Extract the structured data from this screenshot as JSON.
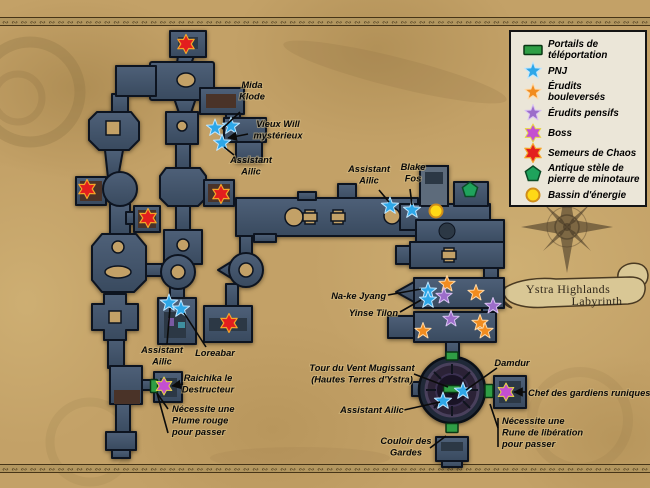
{
  "map_title": {
    "line1": "Ystra Highlands",
    "line2": "Labyrinth"
  },
  "colors": {
    "parchment": "#c3a167",
    "dungeon": "#44566c",
    "portail_vert": "#2f9e45",
    "pnj_bleu": "#2ea7e8",
    "erudit_orange": "#f18c1f",
    "pensif_violet": "#9c6dca",
    "boss_magenta": "#c44fd0",
    "semeur_rouge": "#e31e1e",
    "stele_vert": "#1fa35c",
    "energie_jaune": "#ffd916"
  },
  "decor": {
    "border_glyph": "∾ "
  },
  "legend": {
    "items": [
      {
        "type": "portail",
        "icon": "teleport-portal-icon",
        "label": "Portails de\ntéléportation"
      },
      {
        "type": "pnj",
        "icon": "pnj-star-icon",
        "label": "PNJ"
      },
      {
        "type": "bouleverse",
        "icon": "erudit-bouleverse-star-icon",
        "label": "Érudits bouleversés"
      },
      {
        "type": "pensif",
        "icon": "erudit-pensif-star-icon",
        "label": "Érudits pensifs"
      },
      {
        "type": "boss",
        "icon": "boss-star-icon",
        "label": "Boss"
      },
      {
        "type": "semeur",
        "icon": "semeur-chaos-star-icon",
        "label": "Semeurs de Chaos"
      },
      {
        "type": "stele",
        "icon": "minotaur-stele-icon",
        "label": "Antique stèle de\npierre de minotaure"
      },
      {
        "type": "energie",
        "icon": "energy-pool-icon",
        "label": "Bassin d'énergie"
      }
    ]
  },
  "markers": [
    {
      "type": "portail",
      "x": 452,
      "y": 356,
      "w": 12,
      "h": 8
    },
    {
      "type": "portail",
      "x": 452,
      "y": 389,
      "w": 17,
      "h": 7
    },
    {
      "type": "portail",
      "x": 452,
      "y": 428,
      "w": 12,
      "h": 9
    },
    {
      "type": "portail",
      "x": 489,
      "y": 391,
      "w": 8,
      "h": 13
    },
    {
      "type": "portail",
      "x": 154,
      "y": 386,
      "w": 7,
      "h": 13
    },
    {
      "type": "pnj",
      "x": 215,
      "y": 128
    },
    {
      "type": "pnj",
      "x": 231,
      "y": 126
    },
    {
      "type": "pnj",
      "x": 222,
      "y": 143
    },
    {
      "type": "pnj",
      "x": 390,
      "y": 206
    },
    {
      "type": "pnj",
      "x": 412,
      "y": 210
    },
    {
      "type": "pnj",
      "x": 428,
      "y": 291
    },
    {
      "type": "pnj",
      "x": 428,
      "y": 300
    },
    {
      "type": "pnj",
      "x": 169,
      "y": 303
    },
    {
      "type": "pnj",
      "x": 181,
      "y": 309
    },
    {
      "type": "pnj",
      "x": 443,
      "y": 401
    },
    {
      "type": "pnj",
      "x": 463,
      "y": 391
    },
    {
      "type": "bouleverse",
      "x": 447,
      "y": 284
    },
    {
      "type": "bouleverse",
      "x": 476,
      "y": 293
    },
    {
      "type": "bouleverse",
      "x": 480,
      "y": 323
    },
    {
      "type": "bouleverse",
      "x": 485,
      "y": 331
    },
    {
      "type": "bouleverse",
      "x": 423,
      "y": 331
    },
    {
      "type": "pensif",
      "x": 444,
      "y": 296
    },
    {
      "type": "pensif",
      "x": 493,
      "y": 306
    },
    {
      "type": "pensif",
      "x": 451,
      "y": 319
    },
    {
      "type": "boss",
      "x": 164,
      "y": 386
    },
    {
      "type": "boss",
      "x": 506,
      "y": 392
    },
    {
      "type": "semeur",
      "x": 186,
      "y": 44
    },
    {
      "type": "semeur",
      "x": 87,
      "y": 189
    },
    {
      "type": "semeur",
      "x": 148,
      "y": 218
    },
    {
      "type": "semeur",
      "x": 221,
      "y": 194
    },
    {
      "type": "semeur",
      "x": 229,
      "y": 323
    },
    {
      "type": "stele",
      "x": 470,
      "y": 190
    },
    {
      "type": "energie",
      "x": 436,
      "y": 211
    }
  ],
  "annotations": [
    {
      "id": "mida-klode",
      "lines": [
        "Mida",
        "Klode"
      ],
      "x": 252,
      "y": 88,
      "anchor": "middle",
      "leaders": [
        [
          [
            240,
            112
          ],
          [
            222,
            129
          ]
        ]
      ]
    },
    {
      "id": "vieux-will",
      "lines": [
        "Vieux Will",
        "mystérieux"
      ],
      "x": 278,
      "y": 127,
      "anchor": "middle",
      "leaders": [
        [
          [
            248,
            134
          ],
          [
            228,
            138
          ]
        ]
      ],
      "arrow": true
    },
    {
      "id": "assistant-ailic-1",
      "lines": [
        "Assistant",
        "Ailic"
      ],
      "x": 251,
      "y": 163,
      "anchor": "middle",
      "leaders": [
        [
          [
            234,
            155
          ],
          [
            224,
            147
          ]
        ]
      ]
    },
    {
      "id": "assistant-ailic-2",
      "lines": [
        "Assistant",
        "Ailic"
      ],
      "x": 369,
      "y": 172,
      "anchor": "middle",
      "leaders": [
        [
          [
            379,
            190
          ],
          [
            389,
            202
          ]
        ]
      ]
    },
    {
      "id": "blake-fos",
      "lines": [
        "Blake",
        "Fos"
      ],
      "x": 413,
      "y": 170,
      "anchor": "middle",
      "leaders": [
        [
          [
            410,
            189
          ],
          [
            412,
            205
          ]
        ]
      ]
    },
    {
      "id": "nake-jyang",
      "lines": [
        "Na-ke Jyang"
      ],
      "x": 386,
      "y": 299,
      "anchor": "end",
      "leaders": [
        [
          [
            388,
            295
          ],
          [
            421,
            289
          ]
        ]
      ]
    },
    {
      "id": "yinse-tilon",
      "lines": [
        "Yinse Tilon"
      ],
      "x": 398,
      "y": 316,
      "anchor": "end",
      "leaders": [
        [
          [
            400,
            312
          ],
          [
            421,
            300
          ]
        ]
      ]
    },
    {
      "id": "assistant-ailic-3",
      "lines": [
        "Assistant",
        "Ailic"
      ],
      "x": 162,
      "y": 353,
      "anchor": "middle",
      "leaders": [
        [
          [
            167,
            344
          ],
          [
            170,
            308
          ]
        ]
      ]
    },
    {
      "id": "loreabar",
      "lines": [
        "Loreabar"
      ],
      "x": 215,
      "y": 356,
      "anchor": "middle",
      "leaders": [
        [
          [
            206,
            347
          ],
          [
            184,
            313
          ]
        ]
      ]
    },
    {
      "id": "raichika",
      "lines": [
        "Raichika le",
        "Destructeur"
      ],
      "x": 208,
      "y": 381,
      "anchor": "middle",
      "leaders": [
        [
          [
            183,
            384
          ],
          [
            172,
            386
          ]
        ]
      ],
      "arrow": true
    },
    {
      "id": "plume-rouge",
      "lines": [
        "Nécessite une",
        "Plume rouge",
        "pour passer"
      ],
      "x": 172,
      "y": 412,
      "anchor": "start",
      "leaders": [
        [
          [
            168,
            433
          ],
          [
            157,
            393
          ]
        ],
        [
          [
            168,
            409
          ],
          [
            157,
            393
          ]
        ]
      ]
    },
    {
      "id": "tour-vent",
      "lines": [
        "Tour du Vent Mugissant",
        "(Hautes Terres d'Ystra)"
      ],
      "x": 362,
      "y": 371,
      "anchor": "middle",
      "leaders": [
        [
          [
            414,
            374
          ],
          [
            448,
            387
          ]
        ]
      ]
    },
    {
      "id": "assistant-ailic-4",
      "lines": [
        "Assistant Ailic"
      ],
      "x": 372,
      "y": 413,
      "anchor": "middle",
      "leaders": [
        [
          [
            404,
            410
          ],
          [
            440,
            402
          ]
        ]
      ]
    },
    {
      "id": "damdur",
      "lines": [
        "Damdur"
      ],
      "x": 512,
      "y": 366,
      "anchor": "middle",
      "leaders": [
        [
          [
            497,
            368
          ],
          [
            466,
            390
          ]
        ]
      ]
    },
    {
      "id": "chef-gardiens",
      "lines": [
        "Chef des gardiens runiques"
      ],
      "x": 528,
      "y": 396,
      "anchor": "start",
      "leaders": [
        [
          [
            526,
            392
          ],
          [
            514,
            392
          ]
        ]
      ],
      "arrow": true
    },
    {
      "id": "rune-liberation",
      "lines": [
        "Nécessite une",
        "Rune de libération",
        "pour passer"
      ],
      "x": 502,
      "y": 424,
      "anchor": "start",
      "leaders": [
        [
          [
            498,
            447
          ],
          [
            498,
            418
          ]
        ],
        [
          [
            498,
            428
          ],
          [
            490,
            404
          ]
        ]
      ]
    },
    {
      "id": "couloir-gardes",
      "lines": [
        "Couloir des",
        "Gardes"
      ],
      "x": 406,
      "y": 444,
      "anchor": "middle",
      "leaders": [
        [
          [
            430,
            448
          ],
          [
            446,
            436
          ]
        ]
      ]
    }
  ]
}
